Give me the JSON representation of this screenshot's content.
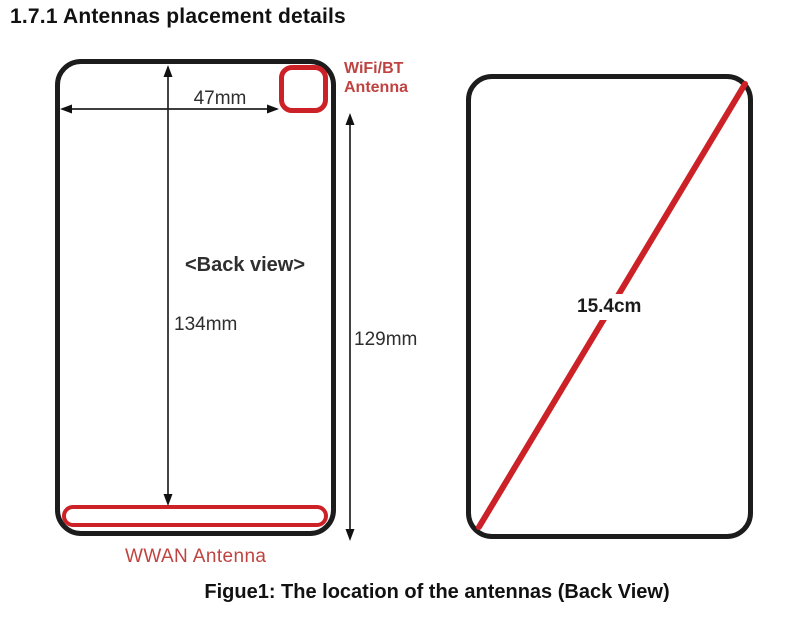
{
  "title": "1.7.1 Antennas placement details",
  "figure": {
    "back_view": {
      "view_label": "<Back view>",
      "wifi_bt_antenna_label": "WiFi/BT\nAntenna",
      "wwan_antenna_label": "WWAN Antenna",
      "dimensions": {
        "antenna_offset_width": "47mm",
        "antenna_offset_height": "134mm",
        "body_height": "129mm"
      }
    },
    "diagonal_view": {
      "screen_diagonal": "15.4cm"
    },
    "caption": "Figue1: The location of the antennas (Back View)"
  },
  "colors": {
    "outline_black": "#1c1c1c",
    "antenna_red": "#cc2127",
    "label_red": "#bf4340",
    "dimension_text": "#2e2e2e"
  }
}
